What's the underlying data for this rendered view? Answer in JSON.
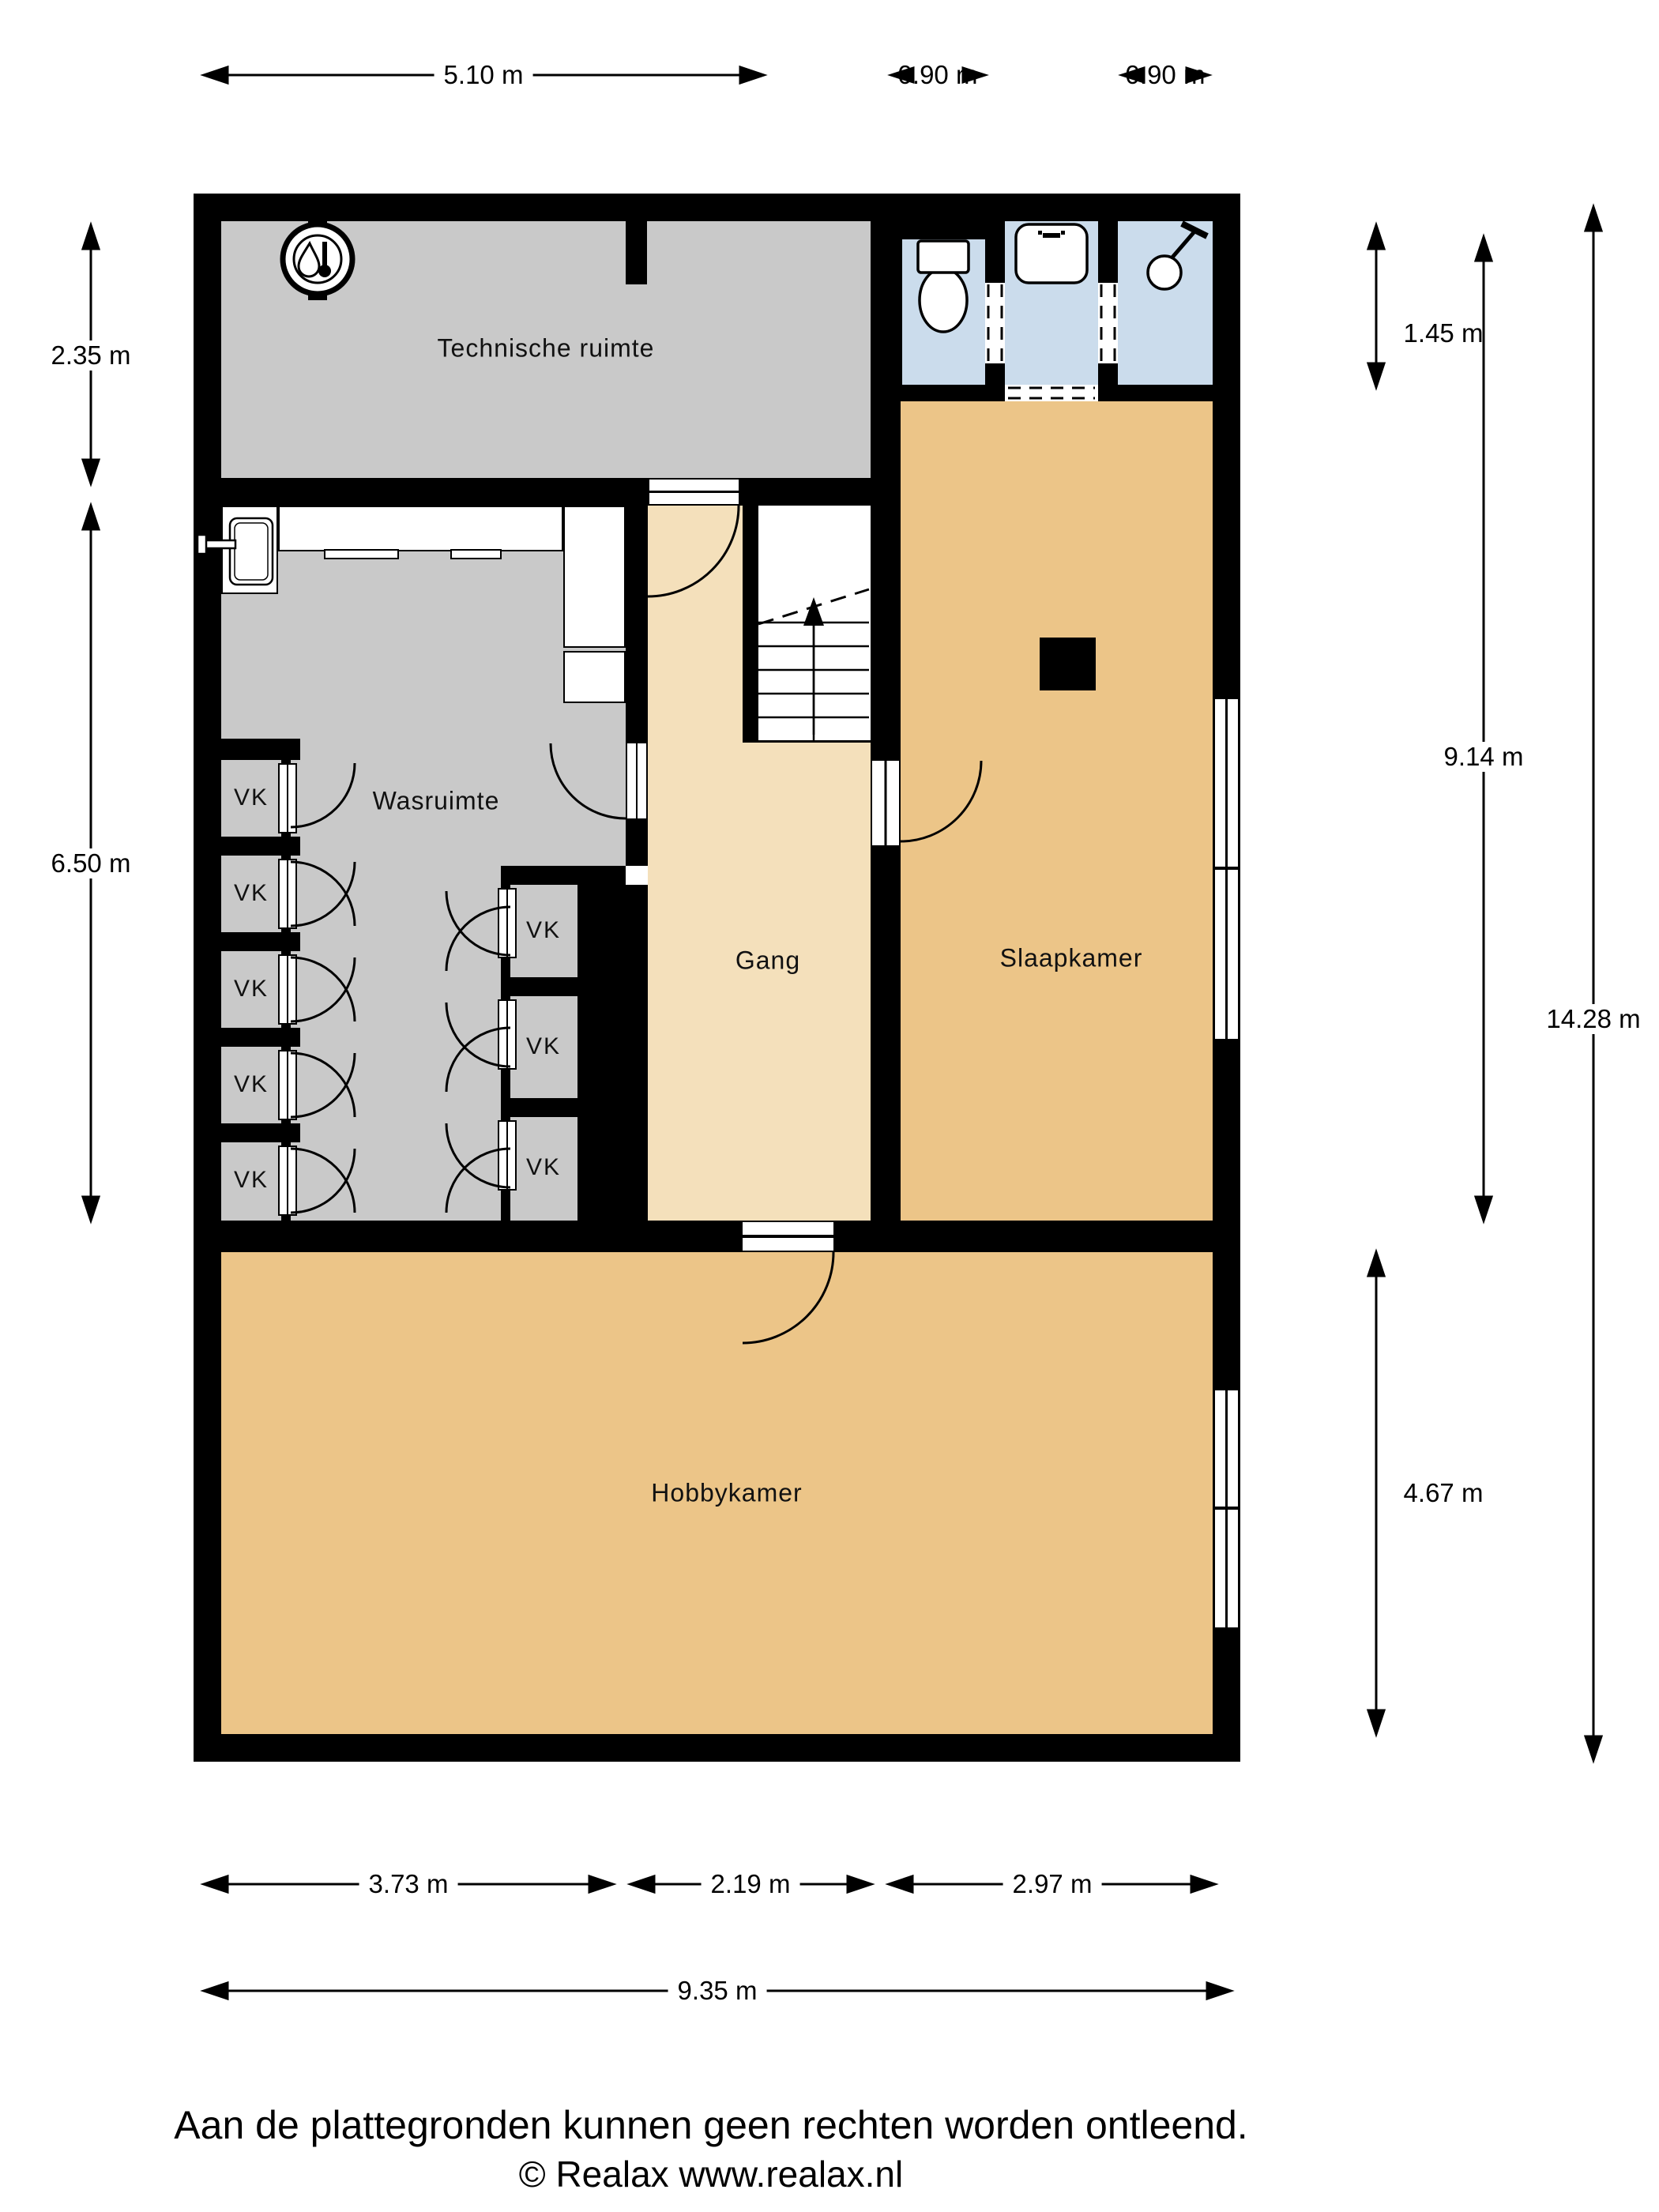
{
  "rooms": {
    "technische_ruimte": "Technische ruimte",
    "wasruimte": "Wasruimte",
    "gang": "Gang",
    "slaapkamer": "Slaapkamer",
    "hobbykamer": "Hobbykamer",
    "closet": "VK"
  },
  "dimensions": {
    "top": [
      "5.10 m",
      "0.90 m",
      "0.90 m"
    ],
    "left": [
      "2.35 m",
      "6.50 m"
    ],
    "right": [
      "1.45 m",
      "9.14 m",
      "14.28 m",
      "4.67 m"
    ],
    "bottom": [
      "3.73 m",
      "2.19 m",
      "2.97 m",
      "9.35 m"
    ]
  },
  "footer": {
    "disclaimer": "Aan de plattegronden kunnen geen rechten worden ontleend.",
    "copyright": "© Realax www.realax.nl"
  },
  "colors": {
    "wall": "#000000",
    "utility_floor": "#c9c9c9",
    "hall_floor": "#f4e0bb",
    "room_floor": "#ecc588",
    "bathroom_floor": "#cbdcec",
    "background": "#ffffff"
  }
}
